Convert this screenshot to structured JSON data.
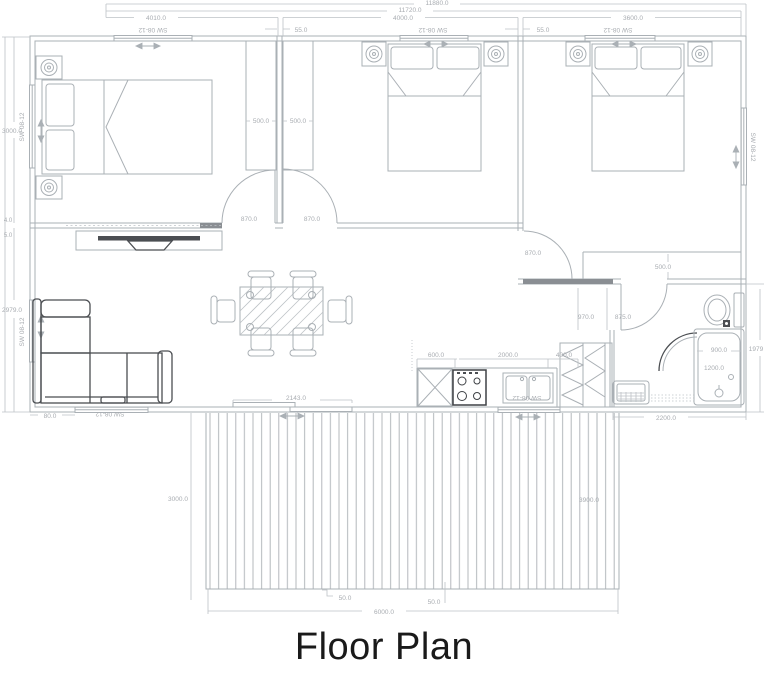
{
  "title": "Floor Plan",
  "window_code": "SW 08-12",
  "colors": {
    "line": "#aab0b5",
    "dim_text": "#a8acb1",
    "dark": "#4b4e52",
    "title": "#1a1a1a"
  },
  "dims": {
    "overall_a": "11880.0",
    "overall_b": "11720.0",
    "bedroom1_width": "4010.0",
    "wall1": "55.0",
    "bedroom2_width": "4000.0",
    "wall2": "55.0",
    "bedroom3_width": "3600.0",
    "left_bedroom1_depth": "3000.0",
    "left_gap_a": "4.0",
    "left_gap_b": "5.0",
    "left_living_depth": "2979.0",
    "wardrobe_left": "500.0",
    "wardrobe_right": "500.0",
    "door_bedroom1": "870.0",
    "door_bedroom2": "870.0",
    "door_bedroom3": "870.0",
    "closet_depth": "500.0",
    "hall_a": "970.0",
    "hall_b": "875.0",
    "kitchen_cabinet": "600.0",
    "kitchen_run": "2000.0",
    "pantry_width": "400.0",
    "sofa_offset": "80.0",
    "sliding_door": "2143.0",
    "tub_width": "900.0",
    "tub_length": "1200.0",
    "bath_height": "1979",
    "bath_width": "2200.0",
    "deck_depth_left": "3000.0",
    "deck_depth_right": "3900.0",
    "deck_gap_left": "50.0",
    "deck_gap_right": "50.0",
    "deck_width": "6000.0"
  }
}
